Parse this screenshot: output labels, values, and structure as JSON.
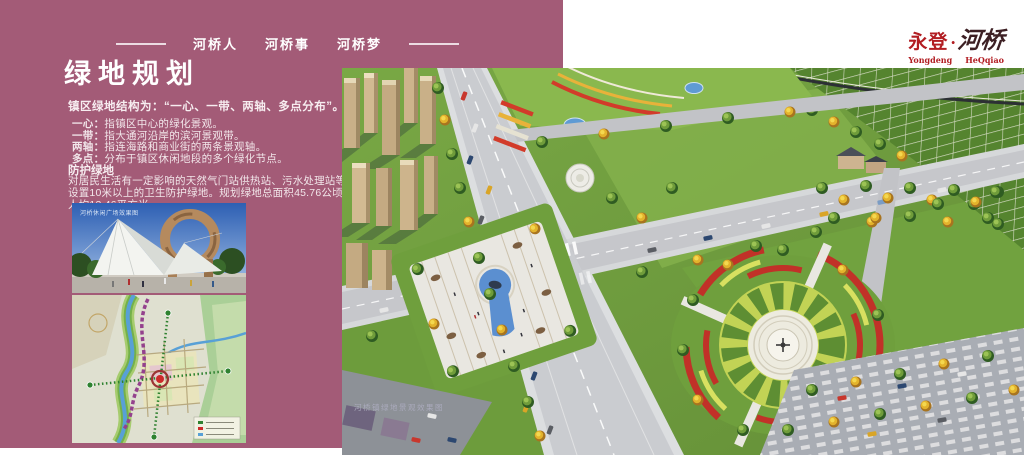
{
  "colors": {
    "panel": "#a35b77",
    "logo_red": "#b21d22",
    "title_text": "#ffffff"
  },
  "header": {
    "nav_items": [
      "河桥人",
      "河桥事",
      "河桥梦"
    ]
  },
  "logo": {
    "cn_left": "永登",
    "dot": "·",
    "cn_right": "河桥",
    "en_left": "Yongdeng",
    "en_right": "HeQqiao"
  },
  "main": {
    "title": "绿地规划",
    "intro": "镇区绿地结构为：“一心、一带、两轴、多点分布”。",
    "bullets": [
      {
        "term": "一心：",
        "desc": "指镇区中心的绿化景观。"
      },
      {
        "term": "一带：",
        "desc": "指大通河沿岸的滨河景观带。"
      },
      {
        "term": "两轴：",
        "desc": "指连海路和商业街的两条景观轴。"
      },
      {
        "term": "多点：",
        "desc": "分布于镇区休闲地段的多个绿化节点。"
      }
    ],
    "section": {
      "heading": "防护绿地",
      "body": "对居民生活有一定影响的天然气门站供热站、污水处理站等设置10米以上的卫生防护绿地。规划绿地总面积45.76公顷,人均13.46平方米。"
    },
    "photo_caption": "河桥休闲广场效果图",
    "render_caption": "河桥镇绿地景观效果图"
  }
}
